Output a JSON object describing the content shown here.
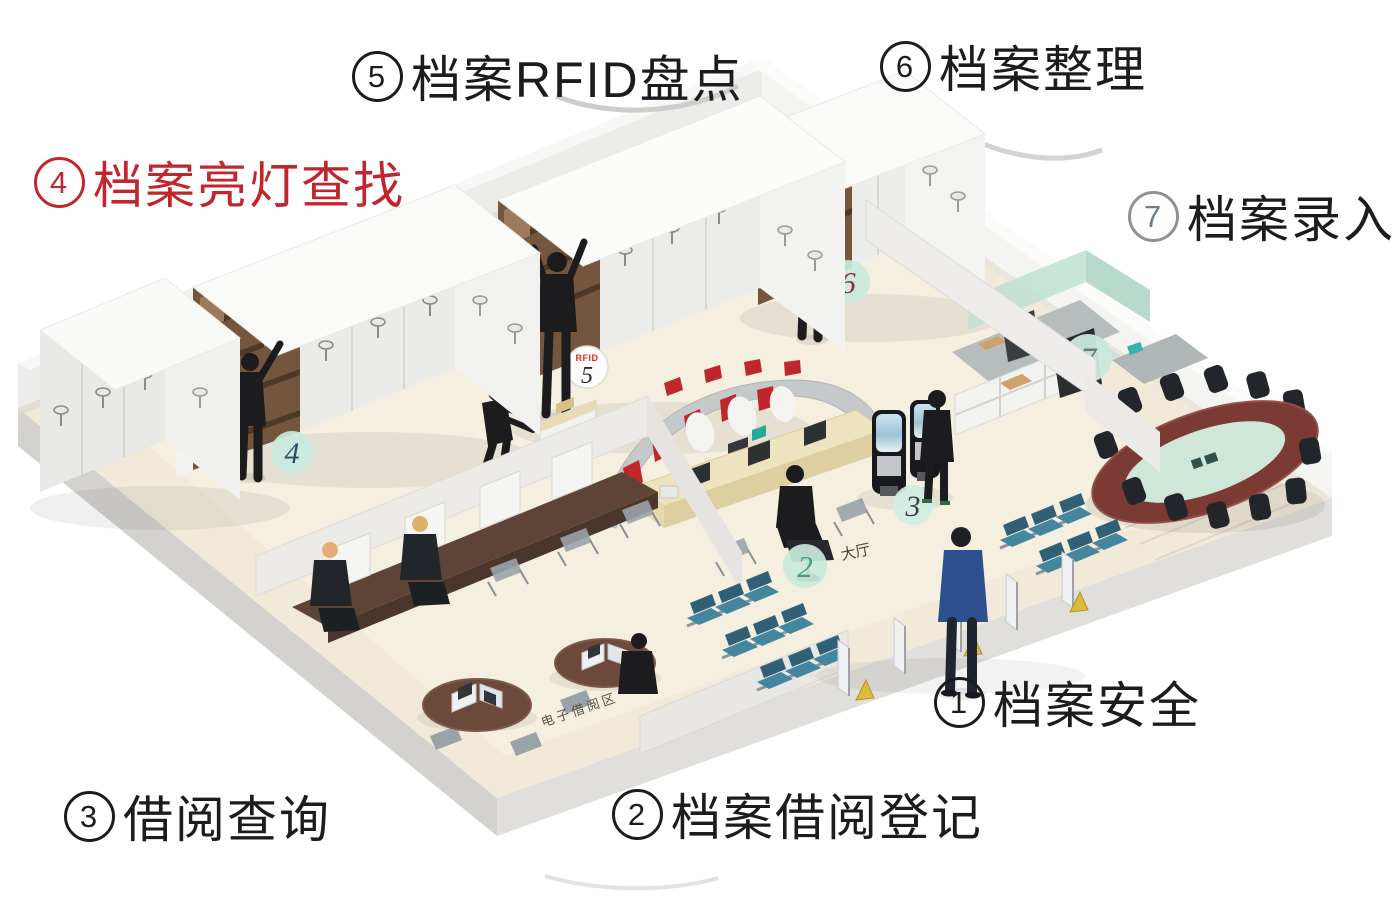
{
  "zone_labels": [
    {
      "number": "1",
      "text": "档案安全"
    },
    {
      "number": "2",
      "text": "档案借阅登记"
    },
    {
      "number": "3",
      "text": "借阅查询"
    },
    {
      "number": "4",
      "text": "档案亮灯查找"
    },
    {
      "number": "5",
      "text": "档案RFID盘点"
    },
    {
      "number": "6",
      "text": "档案整理"
    },
    {
      "number": "7",
      "text": "档案录入"
    }
  ],
  "floor_markers": [
    {
      "zone": "lobby",
      "label": "2",
      "caption": "大厅"
    },
    {
      "zone": "self-service-kiosks",
      "label": "3"
    },
    {
      "zone": "shelving-light-search",
      "label": "4"
    },
    {
      "zone": "shelving-rfid",
      "label": "5",
      "rfid": "RFID"
    },
    {
      "zone": "shelving-sorting",
      "label": "6"
    },
    {
      "zone": "entry-office",
      "label": "7"
    }
  ],
  "scene_texts": {
    "lobby": "大厅",
    "ereading_area": "电子借阅区"
  },
  "colors": {
    "accent_red": "#c0272d",
    "marker_mint": "#c9e9dc",
    "floor_beige": "#f1ead9",
    "wall_white": "#ececea",
    "archive_box_brown": "#74563e",
    "bench_teal": "#44869e",
    "conference_wood": "#7b3a34",
    "conference_glass": "#cfe7d8",
    "people_black": "#1c1c1e",
    "suit_blue": "#2e4f8f"
  }
}
